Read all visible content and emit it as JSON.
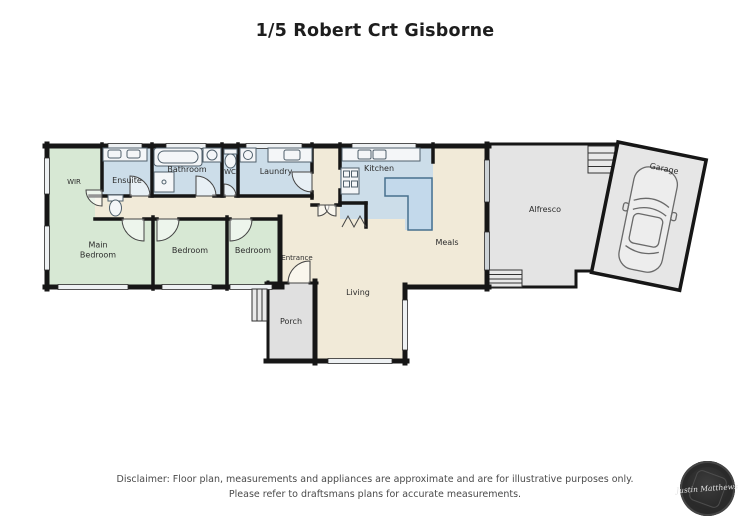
{
  "title": "1/5 Robert Crt Gisborne",
  "rooms": [
    {
      "id": "wir",
      "label": "WIR"
    },
    {
      "id": "ensuite",
      "label": "Ensuite"
    },
    {
      "id": "bathroom",
      "label": "Bathroom"
    },
    {
      "id": "wc",
      "label": "WC"
    },
    {
      "id": "laundry",
      "label": "Laundry"
    },
    {
      "id": "kitchen",
      "label": "Kitchen"
    },
    {
      "id": "main-bedroom",
      "label": "Main Bedroom"
    },
    {
      "id": "bedroom-2",
      "label": "Bedroom"
    },
    {
      "id": "bedroom-3",
      "label": "Bedroom"
    },
    {
      "id": "entrance",
      "label": "Entrance"
    },
    {
      "id": "meals",
      "label": "Meals"
    },
    {
      "id": "living",
      "label": "Living"
    },
    {
      "id": "porch",
      "label": "Porch"
    },
    {
      "id": "alfresco",
      "label": "Alfresco"
    },
    {
      "id": "garage",
      "label": "Garage"
    }
  ],
  "fixtures": [
    "double-vanity",
    "toilet",
    "bathtub",
    "shower",
    "basin",
    "laundry-trough",
    "kitchen-sink",
    "stove",
    "island-bench",
    "pantry-bifold",
    "car",
    "stairs"
  ],
  "colors": {
    "bedroom_green": "#d7e8d4",
    "wet_area_blue": "#ccdde9",
    "living_cream": "#f1ead8",
    "outdoor_gray": "#e4e4e4",
    "wall_black": "#1a1a1a",
    "island_blue": "#c3d9eb"
  },
  "disclaimer": {
    "line1": "Disclaimer: Floor plan, measurements and appliances are approximate and are for illustrative purposes only.",
    "line2": "Please refer to draftsmans plans for accurate measurements."
  },
  "logo": {
    "text": "Justin Matthews"
  }
}
